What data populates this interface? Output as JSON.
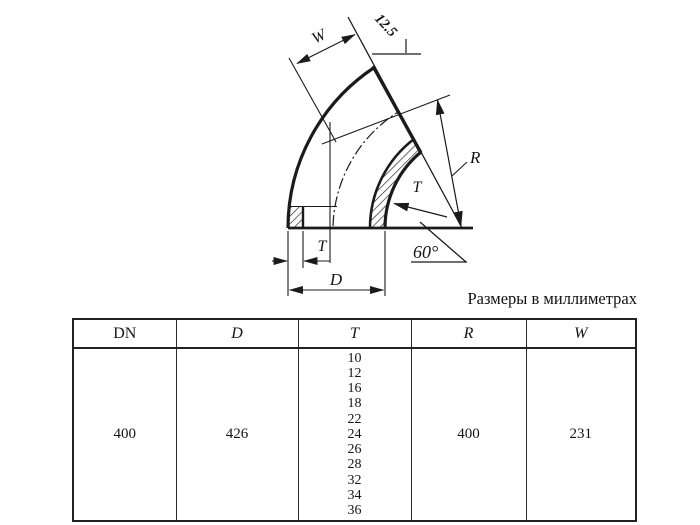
{
  "caption": "Размеры в миллиметрах",
  "drawing": {
    "labels": {
      "width": "W",
      "chamfer": "12.5",
      "radius": "R",
      "wall_top": "T",
      "angle": "60°",
      "wall_bottom": "T",
      "diameter": "D"
    }
  },
  "table": {
    "columns": [
      "DN",
      "D",
      "T",
      "R",
      "W"
    ],
    "row": {
      "dn": "400",
      "d": "426",
      "t_values": [
        "10",
        "12",
        "16",
        "18",
        "22",
        "24",
        "26",
        "28",
        "32",
        "34",
        "36"
      ],
      "r": "400",
      "w": "231"
    }
  },
  "colors": {
    "ink": "#1b1b1b",
    "table_line": "#2b2b2b"
  }
}
